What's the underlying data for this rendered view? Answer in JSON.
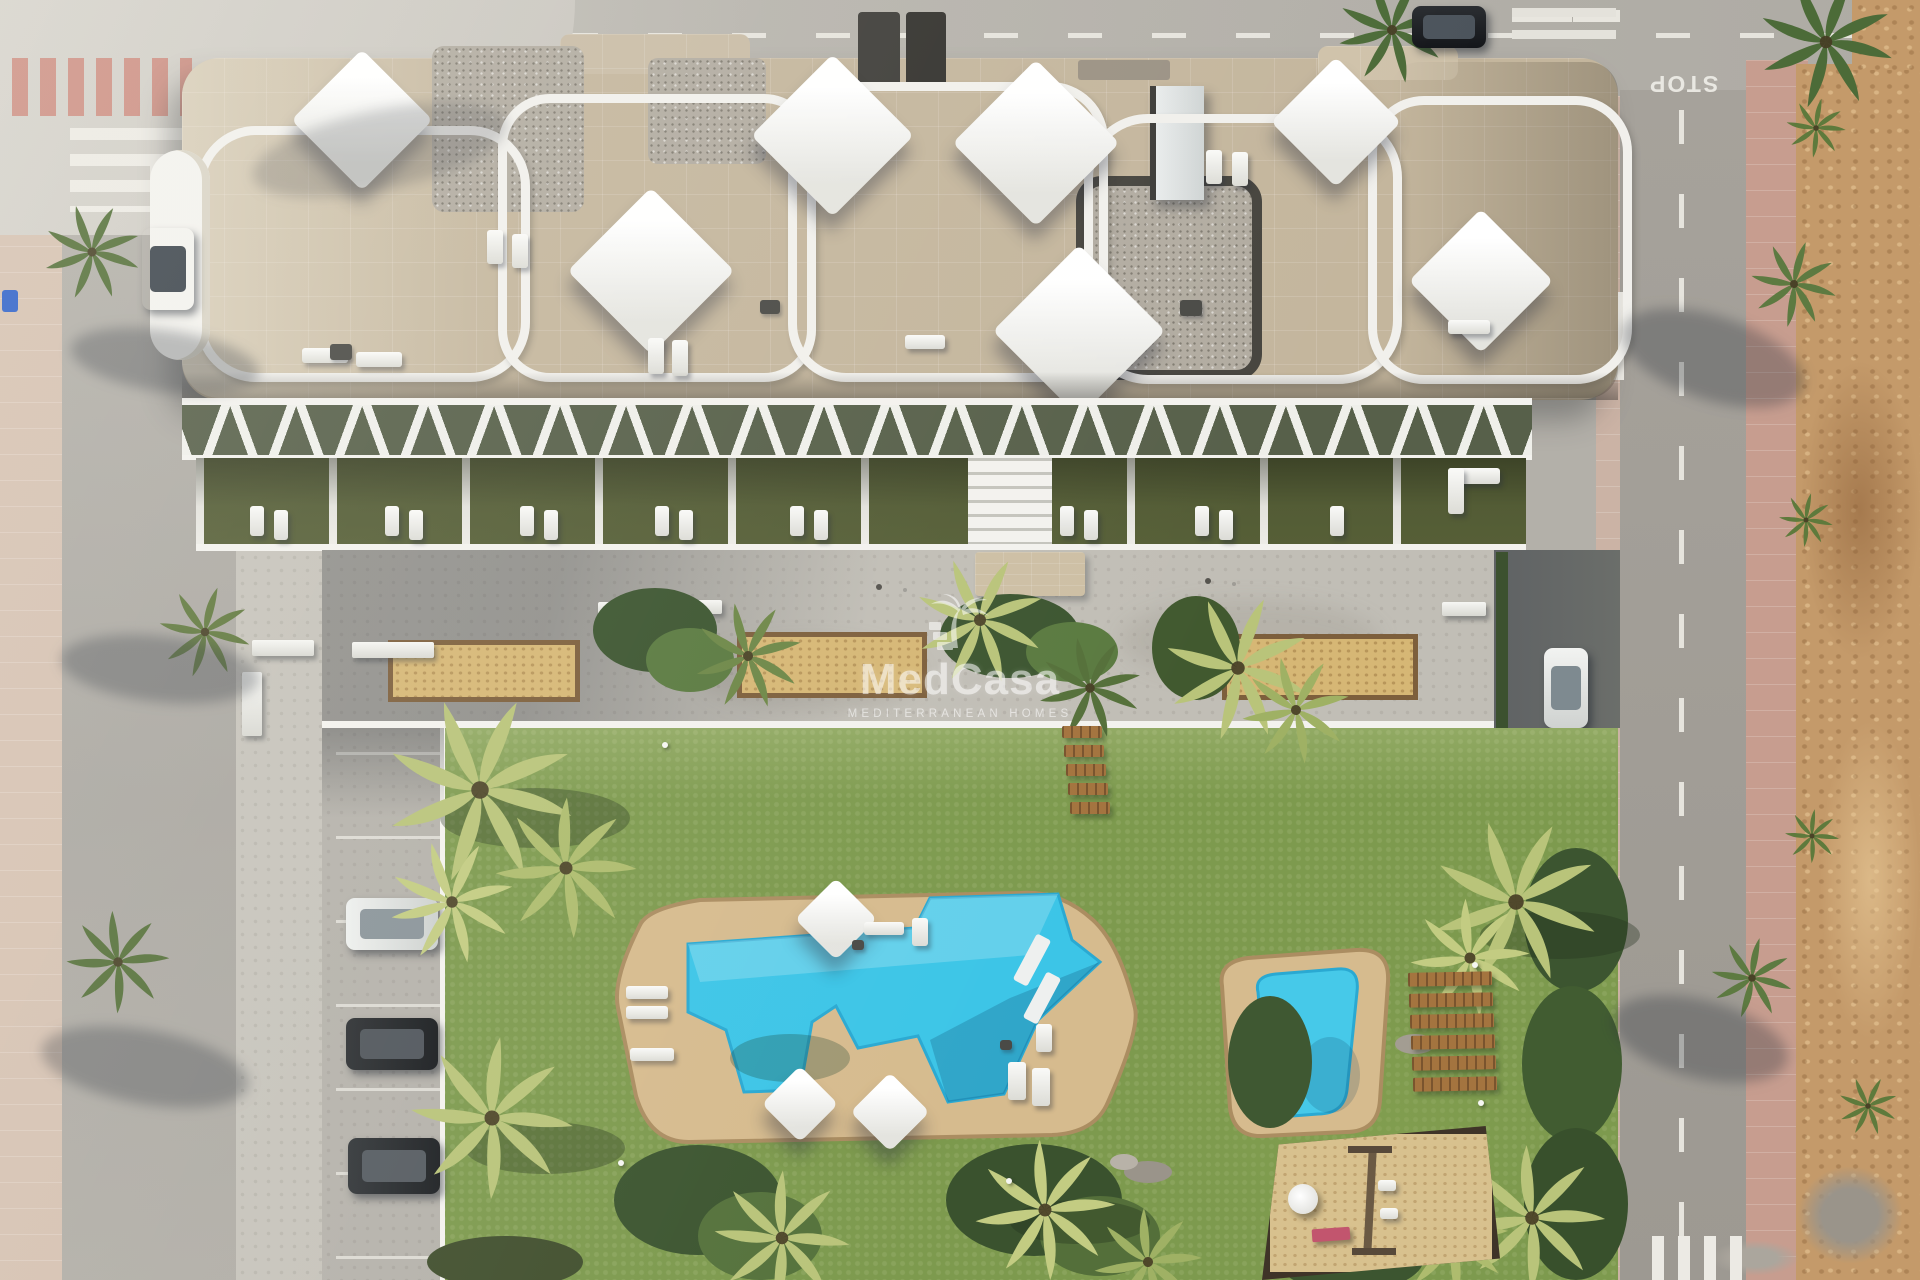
{
  "watermark": {
    "brand": "MedCasa",
    "tagline": "MEDITERRANEAN HOMES",
    "logo": "palm-tree-logo",
    "color": "#ffffff"
  },
  "road_markings": {
    "stop_text": "STOP"
  },
  "palette": {
    "garden_grass": "#7d9a4e",
    "terrace_lawn": "#565f37",
    "pool_water": "#3cc5e7",
    "pool_deck": "#d6bb8e",
    "roof_stone": "#c4b69d",
    "roof_gravel": "#b2aca1",
    "promenade_concrete": "#c1beb6",
    "asphalt": "#a9a59e",
    "sidewalk_pink": "#c79d8f",
    "vacant_dirt": "#c49a6a",
    "planter_sand": "#d6b775",
    "bench_wood": "#a4743f",
    "white_structure": "#f3f2ee",
    "swing_bench_pink": "#c2556e",
    "car_blue_bin": "#2f62c9"
  }
}
